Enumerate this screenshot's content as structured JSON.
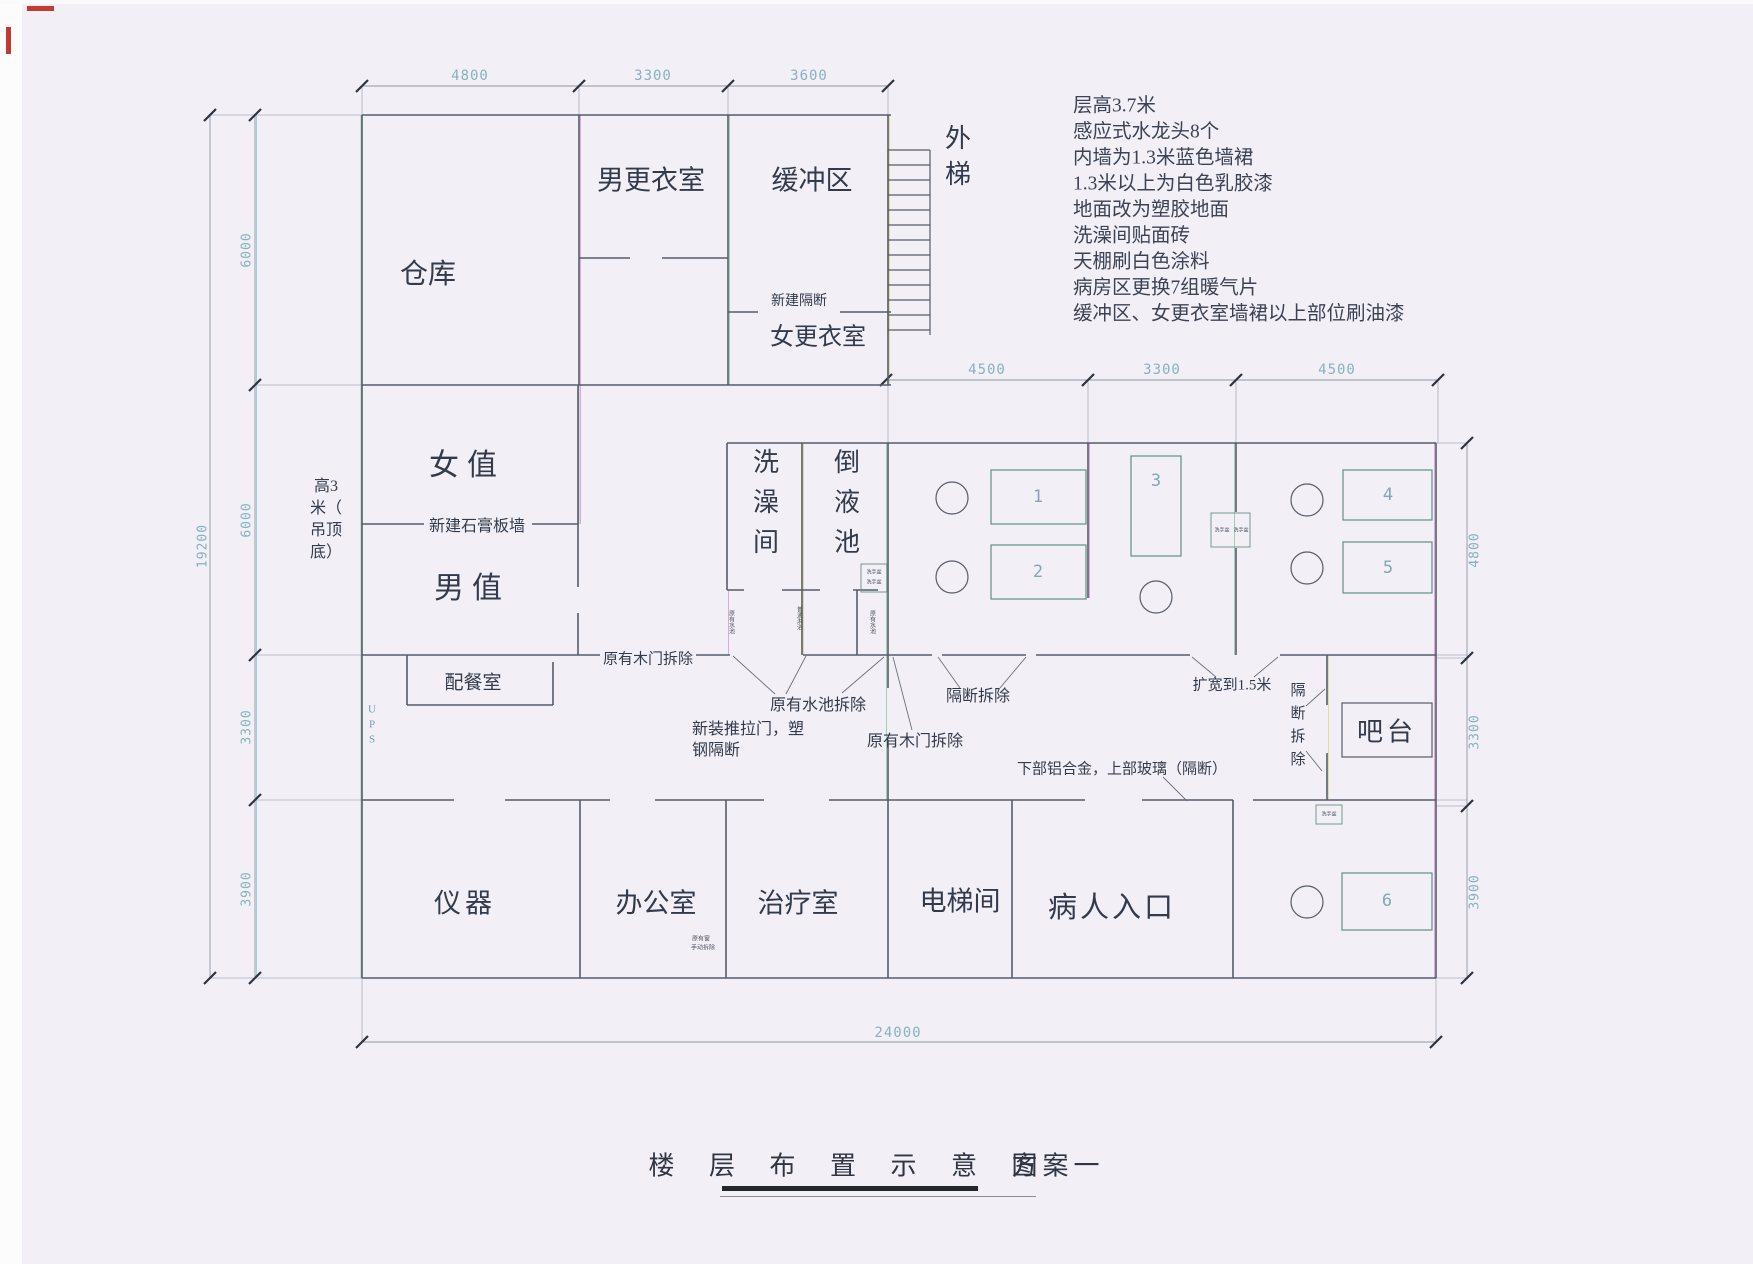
{
  "title": {
    "main": "楼 层 布 置 示 意 图",
    "scheme": "方案一"
  },
  "notes": [
    "层高3.7米",
    "感应式水龙头8个",
    "内墙为1.3米蓝色墙裙",
    "1.3米以上为白色乳胶漆",
    "地面改为塑胶地面",
    "洗澡间贴面砖",
    "天棚刷白色涂料",
    "病房区更换7组暖气片",
    "缓冲区、女更衣室墙裙以上部位刷油漆"
  ],
  "rooms": {
    "warehouse": "仓库",
    "mens_changing": "男更衣室",
    "buffer_zone": "缓冲区",
    "outer_stair": "外梯",
    "womens_changing": "女更衣室",
    "female_duty": "女值",
    "male_duty": "男值",
    "pantry": "配餐室",
    "shower_room": "洗澡间",
    "pour_pool": "倒液池",
    "bar_counter": "吧台",
    "instrument_room": "仪器",
    "office": "办公室",
    "treatment_room": "治疗室",
    "elevator_room": "电梯间",
    "patient_entrance": "病人入口",
    "ups": "UPS"
  },
  "annotations": {
    "new_partition": "新建隔断",
    "new_gypsum_wall": "新建石膏板墙",
    "remove_wood_door_1": "原有木门拆除",
    "remove_pool": "原有水池拆除",
    "sliding_door_line1": "新装推拉门，塑",
    "sliding_door_line2": "钢隔断",
    "remove_wood_door_2": "原有木门拆除",
    "remove_partition_h": "隔断拆除",
    "widen_door": "扩宽到1.5米",
    "remove_partition_v": "隔断拆除",
    "alu_glass": "下部铝合金，上部玻璃（隔断）",
    "height_note_lines": [
      "高3",
      "米（",
      "吊顶",
      "底）"
    ],
    "tiny_pool_left": "原有水池",
    "tiny_shower_mid": "普通淋浴",
    "tiny_pool_right": "原有水池",
    "tiny_basin": "洗手盆",
    "tiny_office_line1": "原有窗",
    "tiny_office_line2": "手动拆除"
  },
  "dimensions": {
    "top": [
      "4800",
      "3300",
      "3600"
    ],
    "ward_top": [
      "4500",
      "3300",
      "4500"
    ],
    "left_segments": [
      "6000",
      "6000",
      "3300",
      "3900"
    ],
    "left_total": "19200",
    "right_segments": [
      "4800",
      "3300",
      "3900"
    ],
    "bottom_total": "24000"
  },
  "furniture_labels": [
    "1",
    "2",
    "3",
    "4",
    "5",
    "6"
  ]
}
